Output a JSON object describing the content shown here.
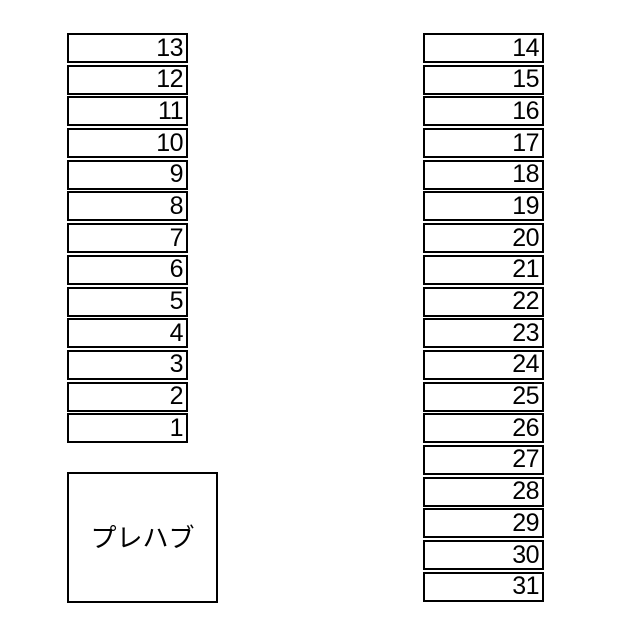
{
  "canvas": {
    "background": "#ffffff",
    "line_color": "#000000"
  },
  "left_column": {
    "cells": [
      "13",
      "12",
      "11",
      "10",
      "9",
      "8",
      "7",
      "6",
      "5",
      "4",
      "3",
      "2",
      "1"
    ]
  },
  "right_column": {
    "cells": [
      "14",
      "15",
      "16",
      "17",
      "18",
      "19",
      "20",
      "21",
      "22",
      "23",
      "24",
      "25",
      "26",
      "27",
      "28",
      "29",
      "30",
      "31"
    ]
  },
  "prefab_box": {
    "label": "プレハブ"
  }
}
